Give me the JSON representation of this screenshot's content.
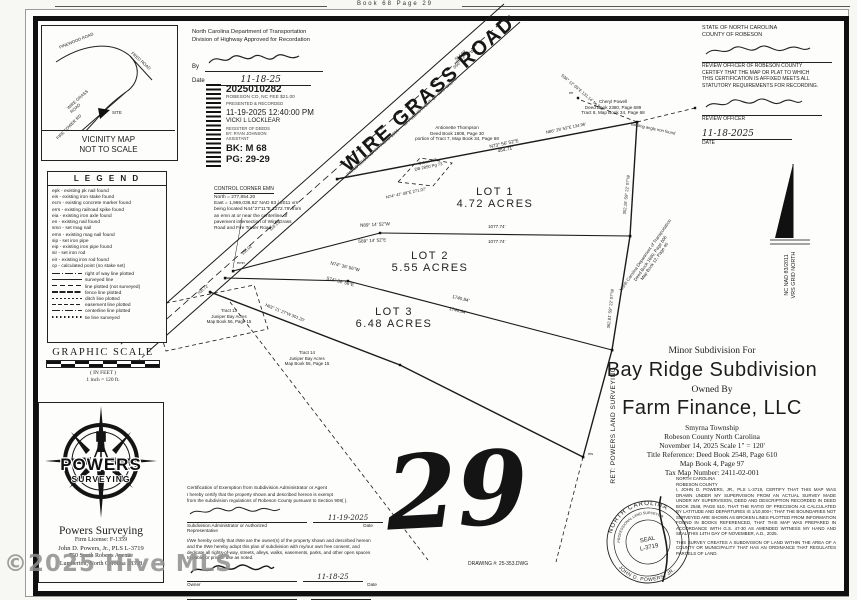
{
  "page": {
    "book_header": "Book 68 Page 29",
    "sheet_number": "29",
    "drawing_number": "DRAWING #: 25-353.DWG",
    "watermark": "©2025 Hive MLS"
  },
  "vicinity": {
    "caption1": "VICINITY MAP",
    "caption2": "NOT TO SCALE",
    "roads": {
      "pinewood": "PINEWOOD ROAD",
      "fred": "FRED ROAD",
      "wire_grass": "WIRE GRASS ROAD",
      "fire_tower": "FIRE TOWER RD",
      "site": "SITE"
    }
  },
  "legend": {
    "title": "L E G E N D",
    "items": [
      "epk - existing pk nail found",
      "eis - existing iron stake found",
      "ecm - existing concrete marker found",
      "errs - existing railroad spike found",
      "eia - existing iron axle found",
      "en - existing nail found",
      "smn - set mag nail",
      "emn - existing mag nail found",
      "sip - set iron pipe",
      "eip - existing iron pipe found",
      "sir - set iron rod",
      "eir - existing iron rod found",
      "cp - calculated point (no stake set)"
    ],
    "line_items": [
      "right of way line plotted",
      "surveyed line",
      "line plotted (not surveyed)",
      "fence line plotted",
      "ditch line plotted",
      "easement line plotted",
      "centerline line plotted",
      "tie line surveyed"
    ]
  },
  "scale_block": {
    "title": "GRAPHIC SCALE",
    "units": "( IN FEET )",
    "ratio": "1 inch = 120 ft."
  },
  "ncdot": {
    "line1": "North Carolina Department of Transportation",
    "line2": "Division of Highway Approved for Recordation",
    "by_label": "By",
    "date_label": "Date",
    "date_value": "11-18-25"
  },
  "stamp": {
    "doc_number": "2025010282",
    "fee_line": "ROBESON CO, NC FEE $21.00",
    "recorded_line": "PRESENTED & RECORDED",
    "datetime": "11-19-2025 12:40:00 PM",
    "register": "VICKI L LOCKLEAR",
    "register_title": "REGISTER OF DEEDS",
    "deputy": "BY: RYAN JOHNSON",
    "deputy_title": "ASSISTANT",
    "book": "BK: M 68",
    "page": "PG: 29-29"
  },
  "control_corner": {
    "title": "CONTROL CORNER EMN",
    "l1": "North = 277,854.20",
    "l2": "East = 1,969,036.82' NAD 83 / 2011 vrs",
    "l3": "being located N44°27'11\"E 1272.79' from",
    "l4": "an emn at or near the centerline of",
    "l5": "pavement intersection of Wire Grass",
    "l6": "Road and Fire Tower Road"
  },
  "road": {
    "name": "WIRE GRASS ROAD",
    "detail": "PAVED SECONDARY ROAD 1336 — 60' PUBLIC RIGHT OF WAY WIDTH",
    "distance": "564.98'",
    "bearing": "S50° 37' 21\"W"
  },
  "lots": [
    {
      "name": "LOT 1",
      "area": "4.72 ACRES"
    },
    {
      "name": "LOT 2",
      "area": "5.55 ACRES"
    },
    {
      "name": "LOT 3",
      "area": "6.48 ACRES"
    }
  ],
  "bearings": {
    "top_line": "N73° 56' 52\"E",
    "top_dist": "454.71'",
    "div1_nw": "N89° 14' 52\"W",
    "div1_se": "S89° 14' 52\"E",
    "div1_dist": "1077.74'",
    "div2_nw": "N74° 36' 56\"W",
    "div2_se": "S74° 36' 56\"E",
    "div2_dist": "1740.84'",
    "right_upper": "352.16'  S9° 22' 07\"W",
    "right_lower": "362.81'  S9° 22' 07\"W",
    "corner_tie": "N86° 29' 53\"E  134.96'",
    "tie_line": "S36° 12' 05\"E  131.14' tie line",
    "angle_iron": "existing angle iron found",
    "orban_line": "N74° 47' 49\"E  271.07'",
    "south_seg": "N63° 21' 27\"W  301.20'",
    "front_seg1": "156.02'",
    "front_seg2": "116.19'",
    "front_seg3": "705.72'"
  },
  "markers": {
    "m1": "eir",
    "m2": "eis",
    "m3": "emn"
  },
  "adjoiners": {
    "thompson1": "Antionette Thompson",
    "thompson2": "Deed Book 1808, Page 30",
    "thompson3": "portion of Tract 7, Map Book 34, Page 68",
    "powell1": "Cheryl Powell",
    "powell2": "Deed Book 2380, Page 689",
    "powell3": "Tract 8, Map Book 34, Page 68",
    "orban1": "Orban Hill",
    "orban2": "DB 2850 Pg 73",
    "tract13_1": "Tract 13",
    "tract13_2": "Juniper Bay Acres",
    "tract13_3": "Map Book 56, Page 15",
    "tract14_1": "Tract 14",
    "tract14_2": "Juniper Bay Acres",
    "tract14_3": "Map Book 56, Page 15",
    "ncdot1": "North Carolina Department of Transportation",
    "ncdot2": "Deed Book 1690, Page 606",
    "ncdot3": "Map Book 12, Page 40",
    "ret": "RET: POWERS LAND SURVEYING"
  },
  "north_arrow": {
    "line1": "NC NAD 83/2011",
    "line2": "VRS GRID NORTH"
  },
  "title_block": {
    "kicker": "Minor Subdivision For",
    "title": "Bay Ridge Subdivision",
    "owned_by": "Owned By",
    "owner": "Farm Finance, LLC",
    "township": "Smyrna Township",
    "county": "Robeson County      North Carolina",
    "date_scale": "November 14, 2025      Scale 1\" = 120'",
    "title_ref": "Title Reference:  Deed Book 2548, Page 610",
    "map_book": "Map Book 4, Page 97",
    "tax_map": "Tax Map Number: 2411-02-001"
  },
  "review": {
    "state": "STATE OF NORTH CAROLINA",
    "county": "COUNTY OF ROBESON",
    "body1": "REVIEW OFFICER OF ROBESON COUNTY",
    "body2": "CERTIFY THAT THE MAP OR PLAT TO WHICH",
    "body3": "THIS CERTIFICATION IS AFFIXED MEETS ALL",
    "body4": "STATUTORY REQUIREMENTS FOR RECORDING.",
    "officer_label": "REVIEW OFFICER",
    "date_label": "DATE",
    "date_value": "11-18-2025"
  },
  "exemption": {
    "title": "Certification of Exemption from Subdivision Administrator or Agent",
    "p1a": "I hereby certify that the property shown and described hereon is exempt",
    "p1b": "from the subdivision regulations of Robeson County pursuant to Section 908(  ).",
    "admin_date": "11-19-2025",
    "admin_label1": "Subdivision Administrator or Authorized",
    "admin_label2": "Representative",
    "date_label": "Date",
    "p2a": "I/We hereby certify that I/We are the owner(s) of the property shown and described hereon",
    "p2b": "and the I/We hereby adopt this plan of subdivision with my/our own free consent, and",
    "p2c": "dedicate all rights-of-way, streets, alleys, walks, easements, parks, and other open spaces",
    "p2d": "to public or private use as noted.",
    "owner_date": "11-18-25",
    "owner_label": "Owner"
  },
  "surveyor_cert": {
    "state": "NORTH CAROLINA",
    "county": "ROBESON COUNTY",
    "p1": "I, JOHN D. POWERS, JR., PLS L-3719, CERTIFY THAT THIS MAP WAS DRAWN UNDER MY SUPERVISION FROM AN ACTUAL SURVEY MADE UNDER MY SUPERVISION, DEED AND DESCRIPTION RECORDED IN DEED BOOK 2548, PAGE 610, THAT THE RATIO OF PRECISION AS CALCULATED BY LATITUDE AND DEPARTURES IS 1/10,000+; THAT THE BOUNDARIES NOT SURVEYED ARE SHOWN AS BROKEN LINES PLOTTED FROM INFORMATION FOUND IN BOOKS REFERENCED, THAT THIS MAP WAS PREPARED IN ACCORDANCE WITH G.S. 47-30 AS AMENDED WITNESS MY HAND AND SEAL THIS 14TH DAY OF NOVEMBER, A.D., 2025.",
    "p2": "THIS SURVEY CREATES A SUBDIVISION OF LAND WITHIN THE AREA OF A COUNTY OR MUNICIPALITY THAT HAS AN ORDINANCE THAT REGULATES PARCELS OF LAND."
  },
  "seal": {
    "arc_top": "NORTH CAROLINA",
    "arc_mid": "PROFESSIONAL LAND SURVEYOR",
    "center1": "SEAL",
    "center2": "L-3719",
    "arc_bottom": "JOHN D. POWERS, JR."
  },
  "powers": {
    "logo1": "POWERS",
    "logo2": "SURVEYING",
    "name": "Powers Surveying",
    "license": "Firm License: F-1359",
    "surveyor": "John D. Powers, Jr., PLS L-3719",
    "address1": "750 South Roberts Avenue",
    "address2": "Lumberton, North Carolina 28358"
  }
}
